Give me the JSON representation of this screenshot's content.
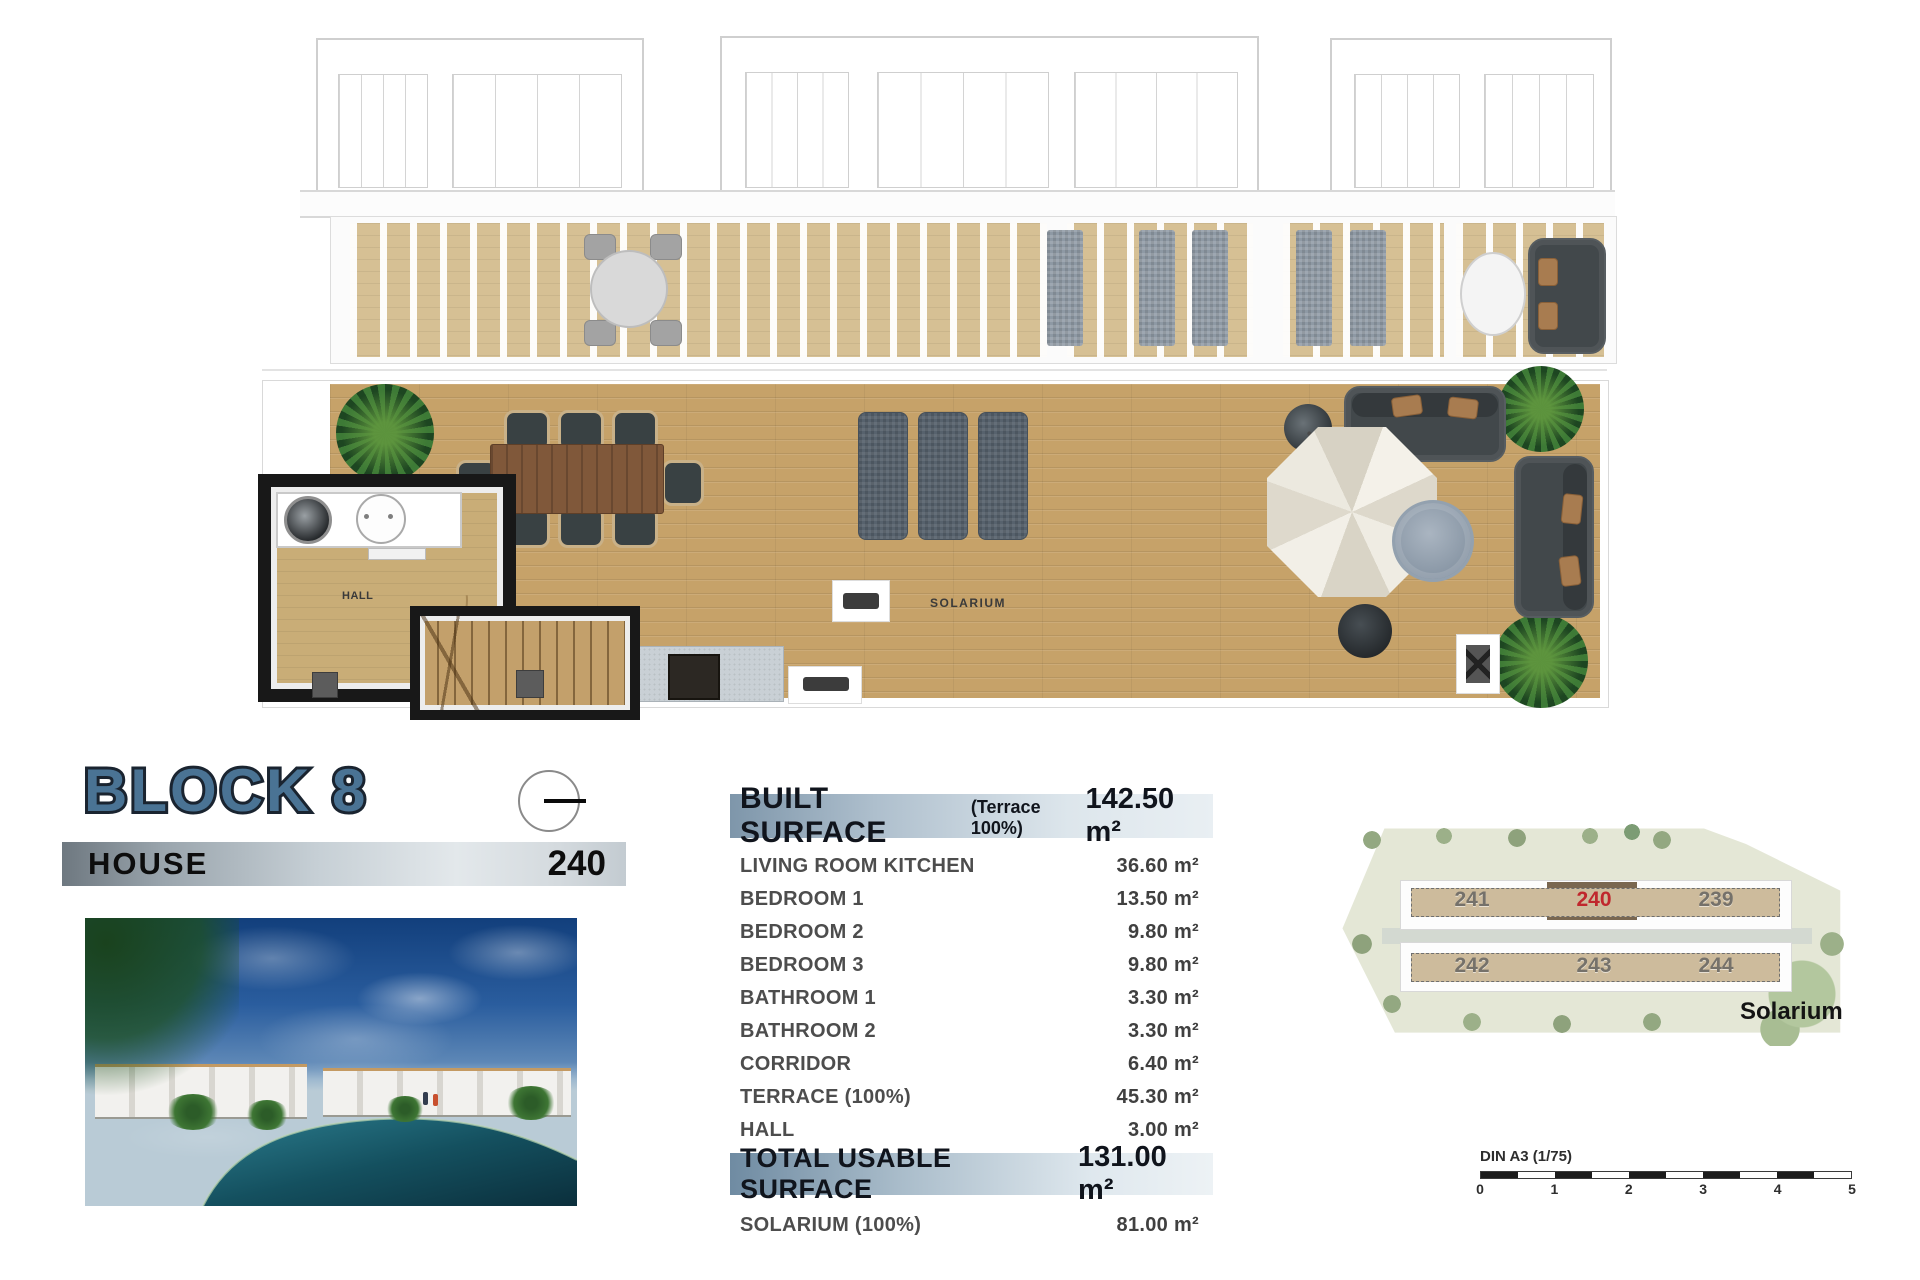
{
  "header": {
    "block_title": "BLOCK 8",
    "house_label": "HOUSE",
    "house_number": "240"
  },
  "floor_plan": {
    "hall_label": "HALL",
    "solarium_label": "SOLARIUM"
  },
  "surface_table": {
    "header": {
      "label": "BUILT SURFACE",
      "note": "(Terrace 100%)",
      "value": "142.50 m²"
    },
    "rows": [
      {
        "label": "LIVING ROOM KITCHEN",
        "value": "36.60 m²"
      },
      {
        "label": "BEDROOM 1",
        "value": "13.50 m²"
      },
      {
        "label": "BEDROOM 2",
        "value": "9.80 m²"
      },
      {
        "label": "BEDROOM 3",
        "value": "9.80 m²"
      },
      {
        "label": "BATHROOM 1",
        "value": "3.30 m²"
      },
      {
        "label": "BATHROOM 2",
        "value": "3.30 m²"
      },
      {
        "label": "CORRIDOR",
        "value": "6.40 m²"
      },
      {
        "label": "TERRACE (100%)",
        "value": "45.30 m²"
      },
      {
        "label": "HALL",
        "value": "3.00 m²"
      }
    ],
    "total": {
      "label": "TOTAL USABLE SURFACE",
      "value": "131.00 m²"
    },
    "extra": {
      "label": "SOLARIUM (100%)",
      "value": "81.00 m²"
    }
  },
  "site_plan": {
    "units_top": [
      "241",
      "240",
      "239"
    ],
    "units_bottom": [
      "242",
      "243",
      "244"
    ],
    "highlighted_unit": "240",
    "caption": "Solarium"
  },
  "scale_bar": {
    "label": "DIN A3 (1/75)",
    "ticks": [
      "0",
      "1",
      "2",
      "3",
      "4",
      "5"
    ]
  },
  "colors": {
    "title_blue": "#4a7394",
    "title_outline": "#1a2430",
    "header_bar_start": "#7e96aa",
    "header_bar_end": "#e9eff3",
    "highlight_red": "#c0272d",
    "deck_wood": "#c6a269"
  }
}
